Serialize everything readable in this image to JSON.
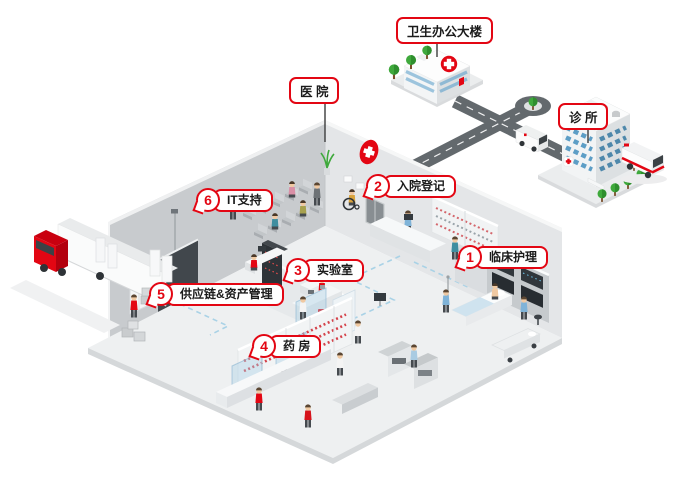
{
  "diagram": {
    "accent_color": "#e30613",
    "buildings": [
      {
        "id": "hospital",
        "label": "医 院"
      },
      {
        "id": "health-office",
        "label": "卫生办公大楼"
      },
      {
        "id": "clinic",
        "label": "诊 所"
      }
    ],
    "callouts": [
      {
        "number": "1",
        "label": "临床护理"
      },
      {
        "number": "2",
        "label": "入院登记"
      },
      {
        "number": "3",
        "label": "实验室"
      },
      {
        "number": "4",
        "label": "药 房"
      },
      {
        "number": "5",
        "label": "供应链&资产管理"
      },
      {
        "number": "6",
        "label": "IT支持"
      }
    ]
  }
}
